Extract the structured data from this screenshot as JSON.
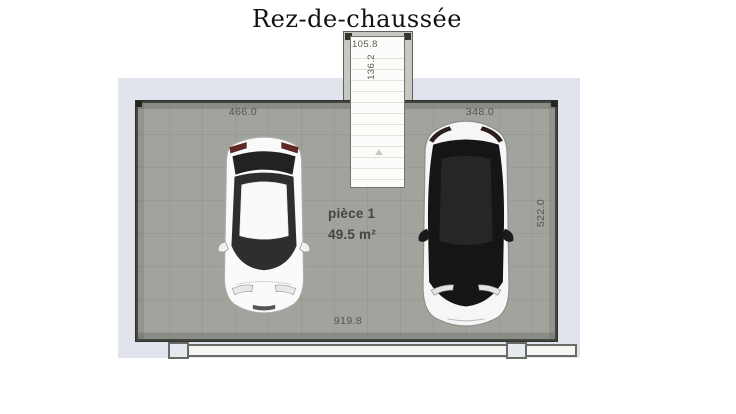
{
  "title": "Rez-de-chaussée",
  "room": {
    "name": "pièce 1",
    "area": "49.5 m²"
  },
  "dimensions": {
    "top_left_wall": "466.0",
    "top_right_wall": "348.0",
    "right_wall": "522.0",
    "bottom_wall": "919.8",
    "stair_width": "105.8",
    "stair_depth": "136.2"
  },
  "icons": {
    "white_car": "car-top-view-white",
    "black_car": "car-top-view-black",
    "staircase": "staircase-treads",
    "stair_arrow": "stair-direction-arrow"
  },
  "colors": {
    "slab": "#e1e4ec",
    "floor": "#a1a49d",
    "wall_edge": "#43463f",
    "stair_tread": "#fcfcfb",
    "dimension_text": "#53564f",
    "room_text": "#44473f",
    "taillight": "#5f2823"
  }
}
